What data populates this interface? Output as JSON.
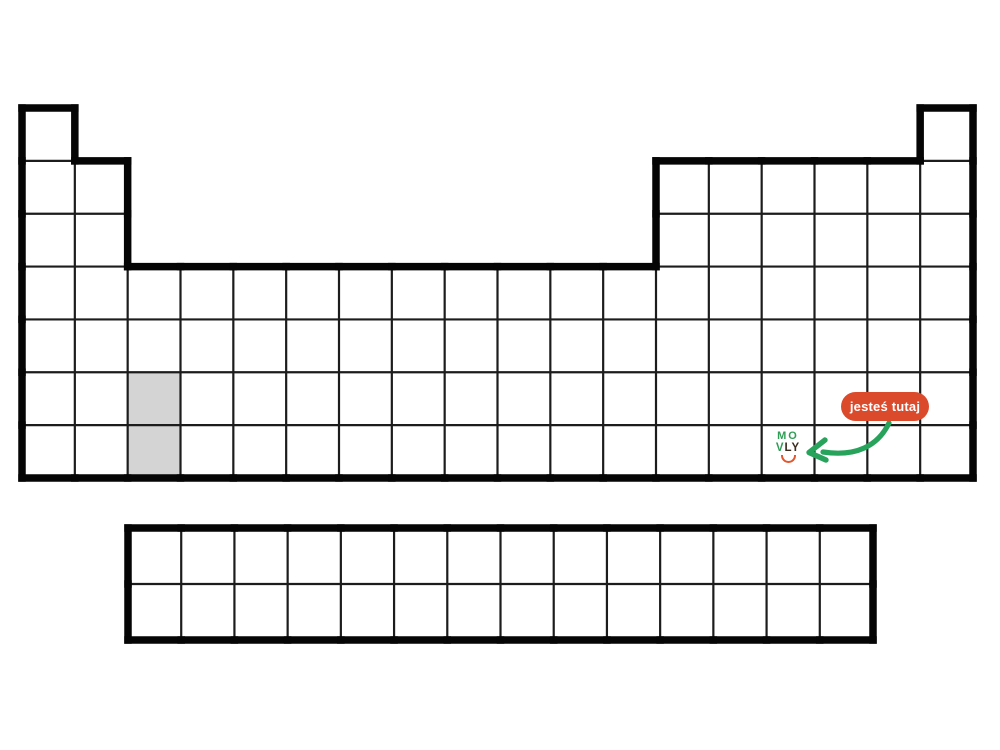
{
  "page": {
    "background": "#ffffff",
    "description": "Blank periodic table outline with you-are-here marker"
  },
  "badge": {
    "label": "jesteś tutaj",
    "bg_color": "#dc4a2c",
    "text_color": "#ffffff"
  },
  "arrow": {
    "color": "#28a35c"
  },
  "logo": {
    "line1": "MO",
    "line2_green": "V",
    "line2_dark": "LY",
    "green_color": "#2f9e55",
    "dark_color": "#3a2c1e",
    "smile_color": "#e4562d"
  },
  "periodic_table": {
    "border_color": "#050505",
    "grid_color": "#1c1c1c",
    "highlight_fill": "#d4d4d4",
    "main": {
      "x": 22,
      "y": 108,
      "width": 951,
      "height": 370,
      "cols": 18,
      "rows": 7,
      "row_segments": [
        [
          [
            1,
            1
          ],
          [
            18,
            18
          ]
        ],
        [
          [
            1,
            2
          ],
          [
            13,
            18
          ]
        ],
        [
          [
            1,
            2
          ],
          [
            13,
            18
          ]
        ],
        [
          [
            1,
            18
          ]
        ],
        [
          [
            1,
            18
          ]
        ],
        [
          [
            1,
            18
          ]
        ],
        [
          [
            1,
            18
          ]
        ]
      ],
      "highlighted_cells": [
        {
          "col": 3,
          "row": 6
        },
        {
          "col": 3,
          "row": 7
        }
      ]
    },
    "bottom": {
      "x": 128,
      "y": 528,
      "width": 745,
      "height": 112,
      "cols": 14,
      "rows": 2
    }
  }
}
